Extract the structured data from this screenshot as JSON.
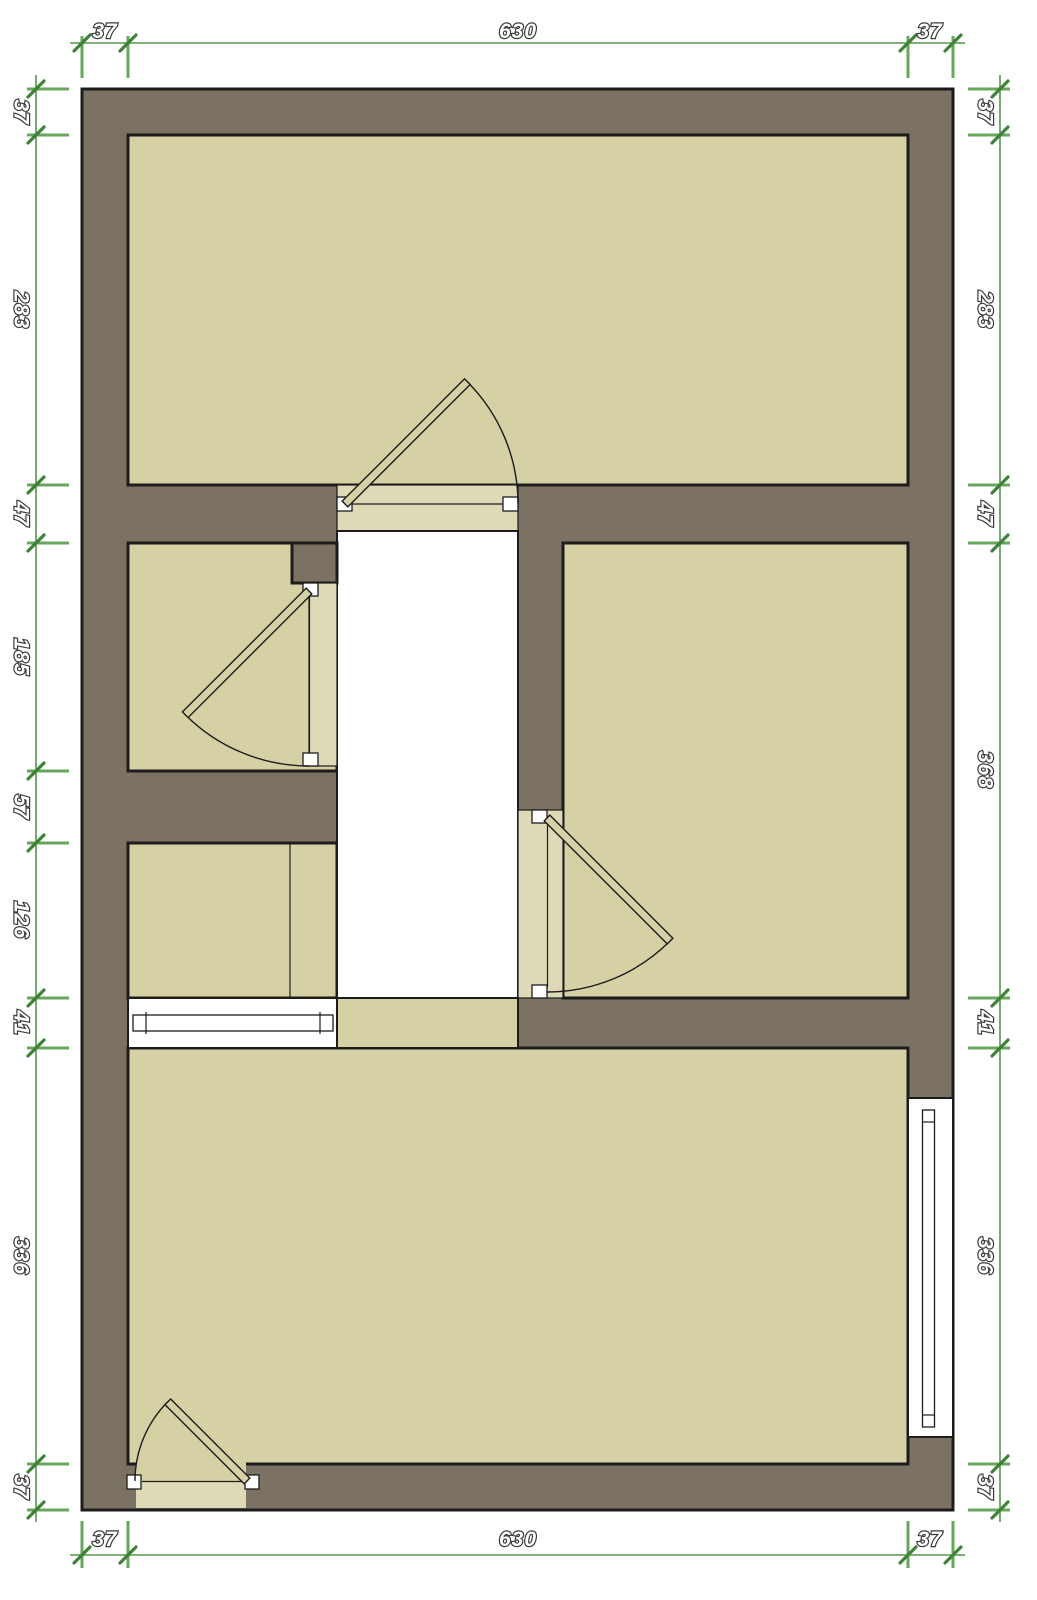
{
  "colors": {
    "wall": "#7b7264",
    "room": "#d6d1a4",
    "hall": "#ffffff",
    "sill": "#ded9b6",
    "outline": "#1c1c1c",
    "dimline": "#55954c",
    "dimbar": "#67a65c",
    "dimtick": "#3e8238",
    "labelfill": "#ffffff",
    "labelstroke": "#3a3a3a"
  },
  "dimensions": {
    "top": [
      "37",
      "630",
      "37"
    ],
    "bottom": [
      "37",
      "630",
      "37"
    ],
    "left": [
      "37",
      "283",
      "47",
      "185",
      "57",
      "126",
      "41",
      "336",
      "37"
    ],
    "right": [
      "37",
      "283",
      "47",
      "368",
      "41",
      "336",
      "37"
    ]
  }
}
